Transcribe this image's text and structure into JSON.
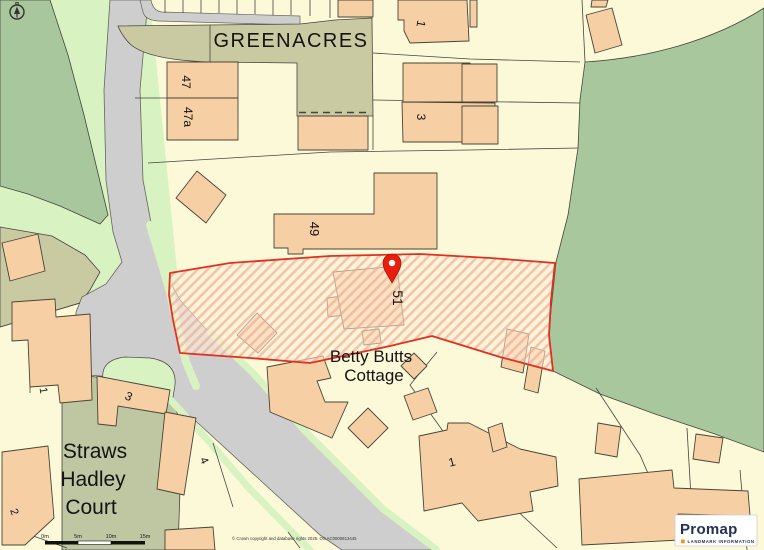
{
  "window": {
    "width": 764,
    "height": 550
  },
  "map": {
    "street_label": "GREENACRES",
    "selection": {
      "plot_number": "51",
      "boundary_color": "#e1301f",
      "pin_color": "#ea1c0c"
    },
    "plots": {
      "p47": "47",
      "p47a": "47a",
      "p49": "49",
      "p51": "51",
      "top_1": "1",
      "top_3": "3",
      "court_1": "1",
      "court_2": "2",
      "court_3": "3",
      "court_4": "4",
      "house_1": "1"
    },
    "place_names": {
      "cottage_line1": "Betty Butts",
      "cottage_line2": "Cottage",
      "court_line1": "Straws",
      "court_line2": "Hadley",
      "court_line3": "Court"
    },
    "scale_bar": {
      "label_0": "0m",
      "label_5": "5m",
      "label_10": "10m",
      "label_15": "15m"
    },
    "copyright": "© Crown copyright and database rights 2025. OS AC0000813445",
    "branding": {
      "name": "Promap",
      "tagline": "LANDMARK INFORMATION",
      "accent_color": "#f7941d",
      "text_color": "#252f56"
    }
  }
}
